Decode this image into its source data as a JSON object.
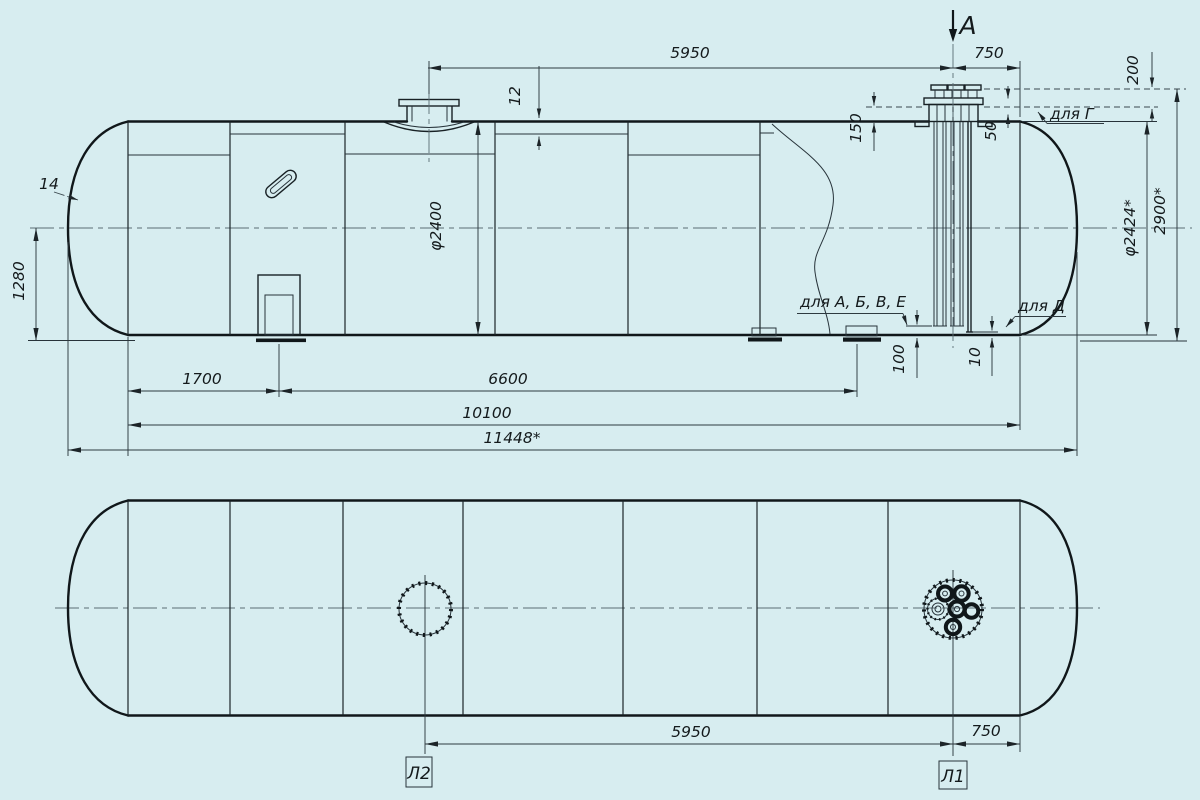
{
  "colors": {
    "background": "#d7edf0",
    "ink": "#10171a"
  },
  "section": {
    "label": "А"
  },
  "elevation": {
    "dim_5950": "5950",
    "dim_750": "750",
    "dim_200": "200",
    "dim_12": "12",
    "dim_150": "150",
    "dim_50": "50",
    "dim_14": "14",
    "dim_1280": "1280",
    "dim_100": "100",
    "dim_10": "10",
    "dim_1700": "1700",
    "dim_6600": "6600",
    "dim_10100": "10100",
    "dim_11448": "11448*",
    "dia_inner": "φ2400",
    "dia_outer": "φ2424*",
    "dim_2900": "2900*",
    "note_g": "для Г",
    "note_abve": "для А, Б, В, Е",
    "note_d": "для Д"
  },
  "plan": {
    "dim_5950": "5950",
    "dim_750": "750",
    "hatch_right_label": "Л1",
    "hatch_left_label": "Л2"
  }
}
